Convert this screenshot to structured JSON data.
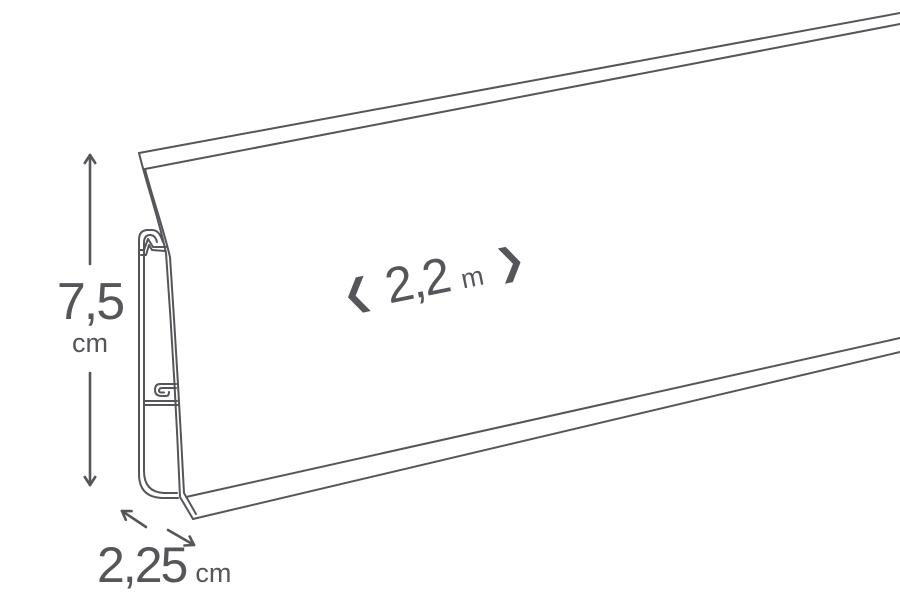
{
  "diagram": {
    "background_color": "#ffffff",
    "line_color": "#54565a",
    "height_dimension": {
      "value": "7,5",
      "unit": "cm"
    },
    "length_dimension": {
      "left_chevron": "❮",
      "value": "2,2",
      "unit": "m",
      "right_chevron": "❯"
    },
    "depth_dimension": {
      "value": "2,25",
      "unit": "cm"
    },
    "icons": {
      "height_up_arrow": "↑",
      "height_down_arrow": "↓",
      "depth_up_left_arrow": "↖",
      "depth_down_right_arrow": "↘"
    }
  }
}
